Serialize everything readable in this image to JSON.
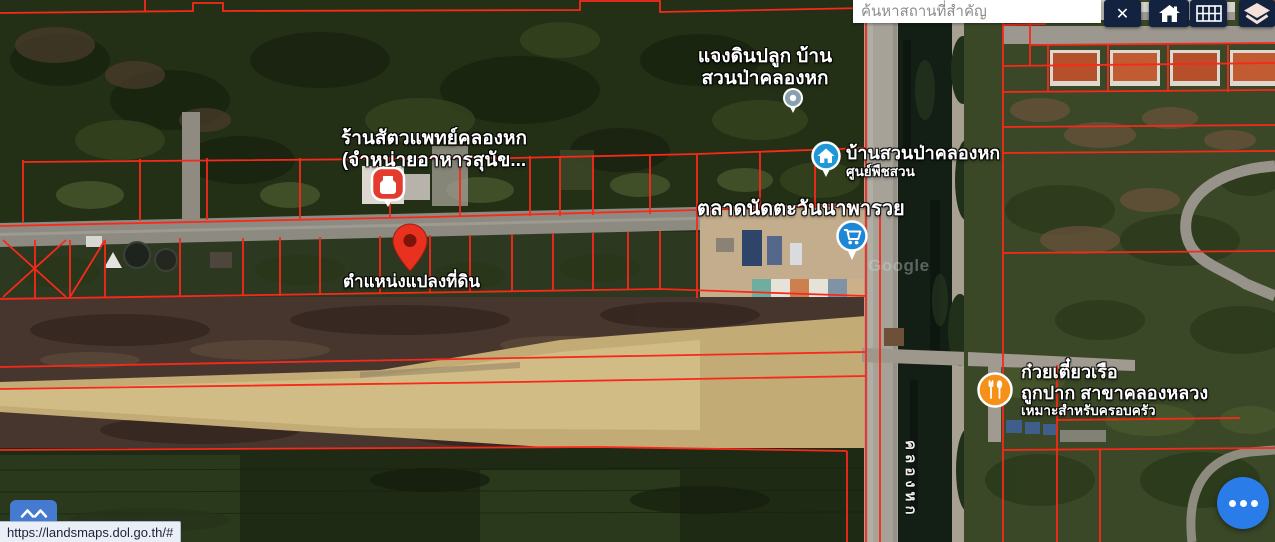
{
  "chrome": {
    "search": {
      "placeholder": "ค้นหาสถานที่สำคัญ",
      "value": ""
    },
    "close_glyph": "✕",
    "status_url": "https://landsmaps.dol.go.th/#"
  },
  "map": {
    "watermark": "Google",
    "canal_label_vertical": "คลองหก",
    "labels": {
      "garden": {
        "line1": "แจงดินปลูก บ้าน",
        "line2": "สวนป่าคลองหก"
      },
      "vet": {
        "line1": "ร้านสัตวแพทย์คลองหก",
        "line2": "(จำหน่ายอาหารสุนัข..."
      },
      "home_garden": {
        "line1": "บ้านสวนป่าคลองหก",
        "line2": "ศูนย์พืชสวน"
      },
      "market": {
        "line1": "ตลาดนัดตะวันนาพารวย"
      },
      "parcel_location": {
        "line1": "ตำแหน่งแปลงที่ดิน"
      },
      "noodle_restaurant": {
        "line1": "ก๋วยเตี๋ยวเรือ",
        "line2": "ถูกปาก สาขาคลองหลวง",
        "line3": "เหมาะสำหรับครอบครัว"
      }
    },
    "icons": {
      "close": "x-mark",
      "home_tool": "house",
      "grid_tool": "grid-table",
      "layers_tool": "stacked-layers",
      "expand_control": "double-chevron-up",
      "more_fab": "three-dots-ellipsis",
      "garden_poi_marker": "gray-poi-dot",
      "vet_marker": "red-square-pin",
      "home_garden_marker": "blue-house-circle-pin",
      "market_marker": "blue-cart-circle-pin",
      "parcel_marker": "red-teardrop-pin",
      "restaurant_marker": "orange-utensils-circle-pin"
    }
  },
  "colors": {
    "parcel_line": "#f8291a",
    "toolbar_bg": "#13233f",
    "fab_blue": "#2a7de9",
    "marker_blue": "#1b87d6",
    "marker_orange": "#f59018",
    "pin_red": "#e8311f",
    "layers_icon": "#f4e1da"
  }
}
